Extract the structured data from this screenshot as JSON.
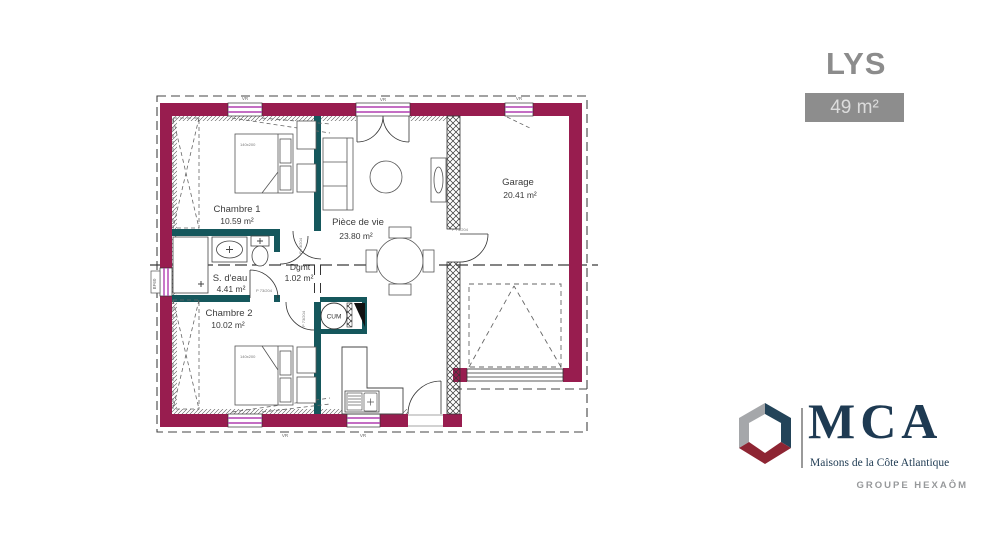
{
  "header": {
    "title": "LYS",
    "area_badge": "49 m²"
  },
  "plan": {
    "rooms": {
      "chambre1": {
        "name": "Chambre 1",
        "area": "10.59 m²"
      },
      "sdeau": {
        "name": "S. d'eau",
        "area": "4.41 m²"
      },
      "chambre2": {
        "name": "Chambre 2",
        "area": "10.02 m²"
      },
      "degagement": {
        "name": "Dgmt",
        "area": "1.02 m²"
      },
      "piece_de_vie": {
        "name": "Pièce de vie",
        "area": "23.80 m²"
      },
      "garage": {
        "name": "Garage",
        "area": "20.41 m²"
      }
    },
    "tags": {
      "water_heater": "CUM",
      "bed_size": "140x200",
      "door": "P 73/204",
      "window_shutter": "VR",
      "left_window": "BF60"
    },
    "colors": {
      "exterior_wall": "#981D4F",
      "interior_wall": "#15575C",
      "window_accent": "#B03FB0"
    }
  },
  "logo": {
    "brand": "MCA",
    "tagline": "Maisons de la Côte Atlantique",
    "group": "GROUPE HEXAÔM"
  }
}
